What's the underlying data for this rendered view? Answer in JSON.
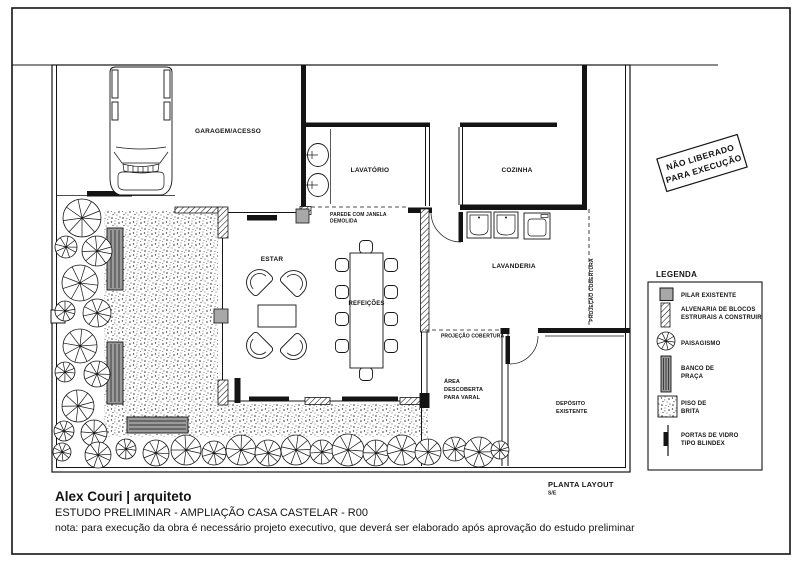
{
  "rooms": {
    "garagem": "GARAGEM/ACESSO",
    "lavatorio": "LAVATÓRIO",
    "cozinha": "COZINHA",
    "estar": "ESTAR",
    "refeicoes": "REFEIÇÕES",
    "lavanderia": "LAVANDERIA",
    "varal_l1": "ÁREA",
    "varal_l2": "DESCOBERTA",
    "varal_l3": "PARA VARAL",
    "deposito_l1": "DEPÓSITO",
    "deposito_l2": "EXISTENTE"
  },
  "notes": {
    "parede_l1": "PAREDE COM JANELA",
    "parede_l2": "DEMOLIDA",
    "projecao_h": "PROJEÇÃO COBERTURA",
    "projecao_v": "PROJEÇÃO COBERTURA"
  },
  "stamp": {
    "line1": "NÃO LIBERADO",
    "line2": "PARA EXECUÇÃO"
  },
  "legend": {
    "title": "LEGENDA",
    "items": [
      {
        "symbol": "pilar-existente-swatch",
        "line1": "PILAR EXISTENTE",
        "line2": ""
      },
      {
        "symbol": "alvenaria-hatch-swatch",
        "line1": "ALVENARIA DE BLOCOS",
        "line2": "ESTRURAIS A CONSTRUIR"
      },
      {
        "symbol": "paisagismo-tree-symbol",
        "line1": "PAISAGISMO",
        "line2": ""
      },
      {
        "symbol": "banco-de-praca-swatch",
        "line1": "BANCO DE",
        "line2": "PRAÇA"
      },
      {
        "symbol": "piso-de-brita-swatch",
        "line1": "PISO DE",
        "line2": "BRITA"
      },
      {
        "symbol": "porta-blindex-symbol",
        "line1": "PORTAS DE VIDRO",
        "line2": "TIPO BLINDEX"
      }
    ]
  },
  "titleblock": {
    "drawing_title": "PLANTA LAYOUT",
    "scale": "S/E",
    "author": "Alex Couri | arquiteto",
    "project": "ESTUDO PRELIMINAR - AMPLIAÇÃO CASA CASTELAR - R00",
    "note": "nota: para execução da obra é necessário projeto executivo, que deverá ser elaborado após aprovação do estudo preliminar"
  },
  "colors": {
    "ink": "#141414",
    "pillar_gray": "#a8a8a8",
    "bench_gray": "#9a9a9a",
    "paper": "#ffffff"
  }
}
